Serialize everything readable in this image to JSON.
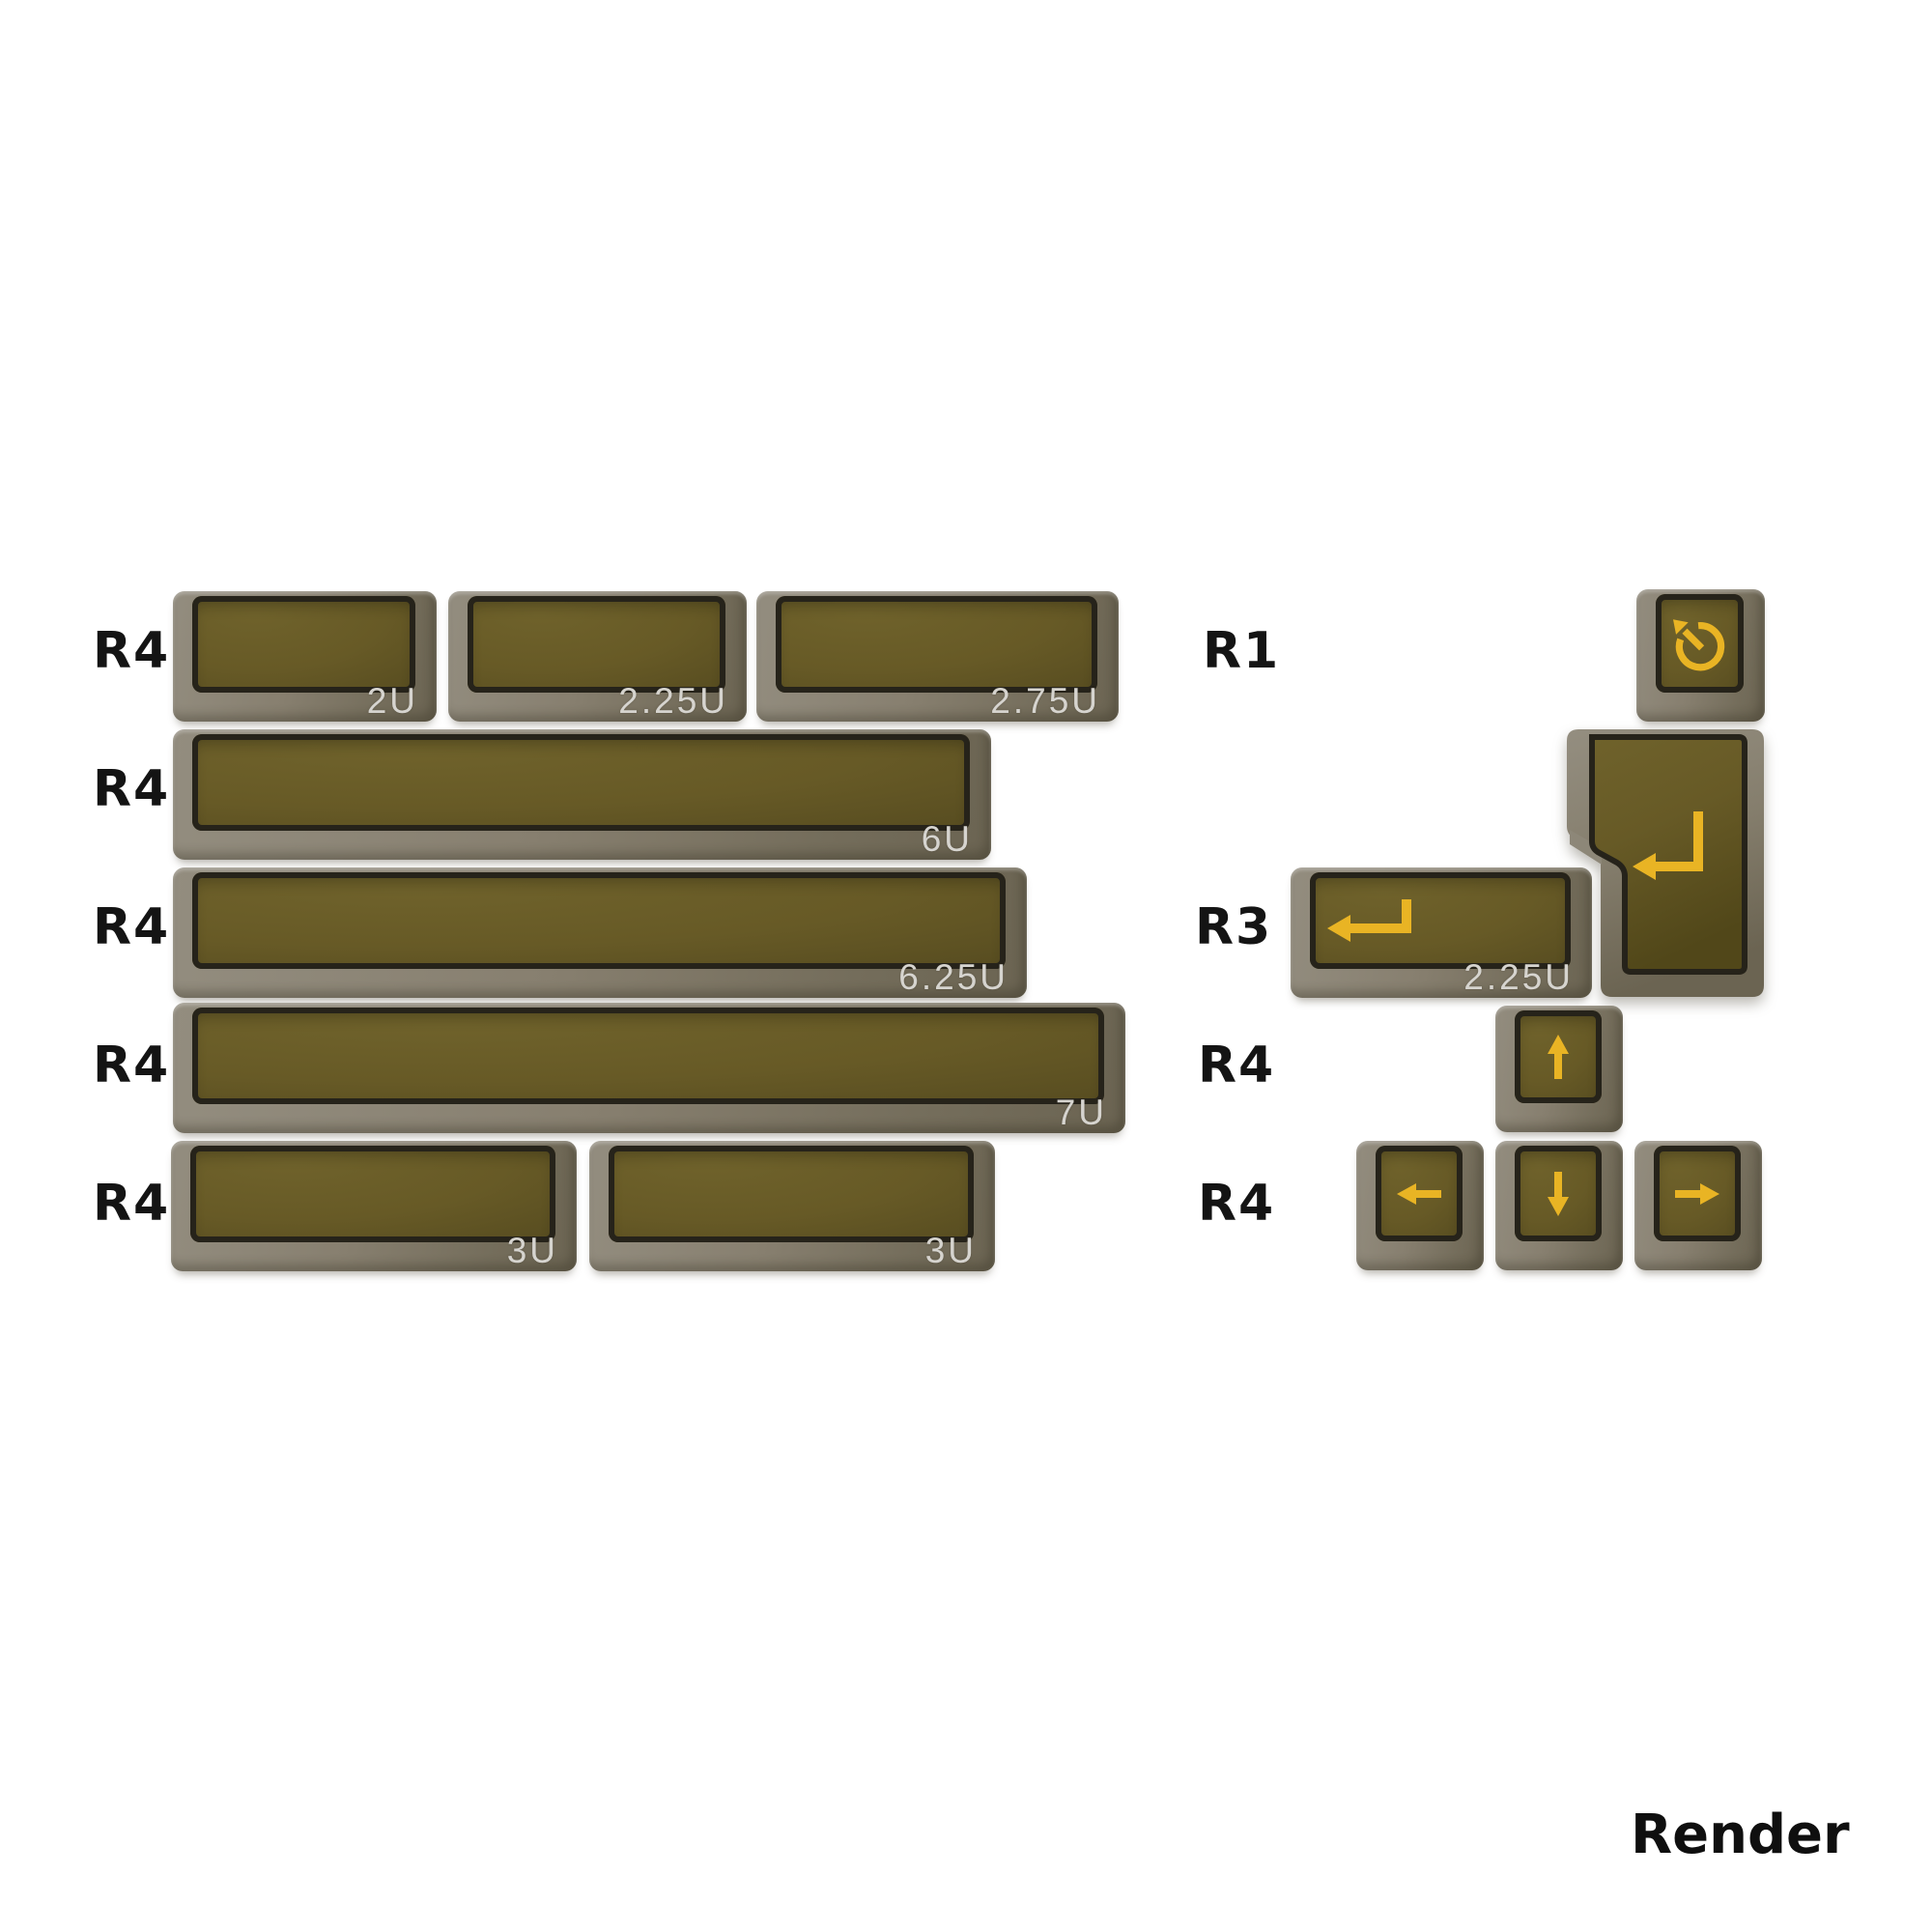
{
  "left_rows": [
    {
      "label": "R4",
      "keys": [
        {
          "size": "2U"
        },
        {
          "size": "2.25U"
        },
        {
          "size": "2.75U"
        }
      ]
    },
    {
      "label": "R4",
      "keys": [
        {
          "size": "6U"
        }
      ]
    },
    {
      "label": "R4",
      "keys": [
        {
          "size": "6.25U"
        }
      ]
    },
    {
      "label": "R4",
      "keys": [
        {
          "size": "7U"
        }
      ]
    },
    {
      "label": "R4",
      "keys": [
        {
          "size": "3U"
        },
        {
          "size": "3U"
        }
      ]
    }
  ],
  "right_rows": [
    {
      "label": "R1"
    },
    {
      "label": "R3"
    },
    {
      "label": "R4"
    },
    {
      "label": "R4"
    }
  ],
  "right_keys": {
    "undo": {
      "icon": "rotate-ccw"
    },
    "iso_enter": {
      "icon": "return"
    },
    "return_2_25": {
      "icon": "return",
      "size": "2.25U"
    },
    "up": {
      "icon": "arrow-up"
    },
    "left": {
      "icon": "arrow-left"
    },
    "down": {
      "icon": "arrow-down"
    },
    "right": {
      "icon": "arrow-right"
    }
  },
  "footer": {
    "render_label": "Render"
  },
  "colors": {
    "background": "#ffffff",
    "keycap_face": "#675a26",
    "keycap_skirt": "#877f6f",
    "keycap_rim": "#26231a",
    "legend_gold": "#e9b424",
    "size_label": "#d6d4cf",
    "text_black": "#141414"
  }
}
